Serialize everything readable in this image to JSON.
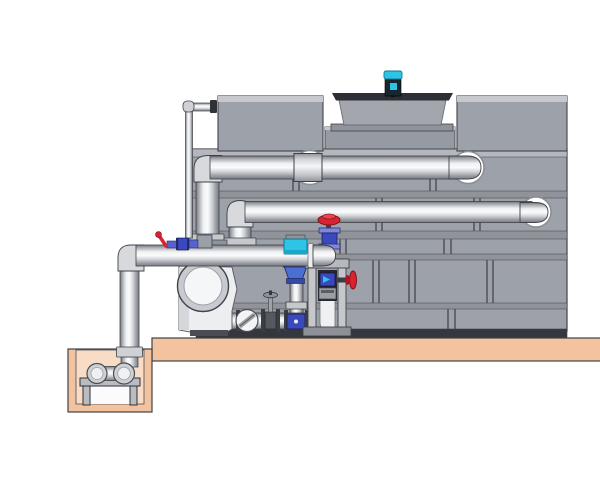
{
  "scene": {
    "kind": "technical-illustration",
    "subject": "cooling-tower-with-circulation-pump-and-piping",
    "components": [
      "cooling-tower-casing",
      "tower-panel-grid",
      "tower-top-boxes",
      "fan-cowl",
      "fan-motor",
      "hot-water-pipe",
      "return-water-pipe",
      "overflow-pipe",
      "suction-header-pipe",
      "circulation-pump",
      "check-valve",
      "gate-valve",
      "makeup-valve-cluster",
      "control-valve",
      "globe-valve",
      "drain-valve",
      "valve-rack",
      "discharge-riser",
      "equipment-pad",
      "sump-pit",
      "sump-suction-assembly"
    ]
  },
  "colors": {
    "background": "#ffffff",
    "tower_gray": "#9da1a9",
    "tower_panel": "#a7aab1",
    "tower_seam": "#4b4e54",
    "tower_bevel": "#c7c9ce",
    "tower_dark_base": "#34373d",
    "pedestal_gray": "#969aa2",
    "cowl_gray": "#a3a6ad",
    "cowl_rim_dark": "#2c2f35",
    "concrete": "#f2c39e",
    "concrete_light": "#f8dcc5",
    "cyan": "#2fc3e6",
    "motor_dark": "#16262e",
    "valve_red": "#d92332",
    "valve_blue": "#3a49bd",
    "valve_blue_light": "#7e86dd",
    "steel_light": "#c5c7cb",
    "panel_dark": "#26282d"
  }
}
